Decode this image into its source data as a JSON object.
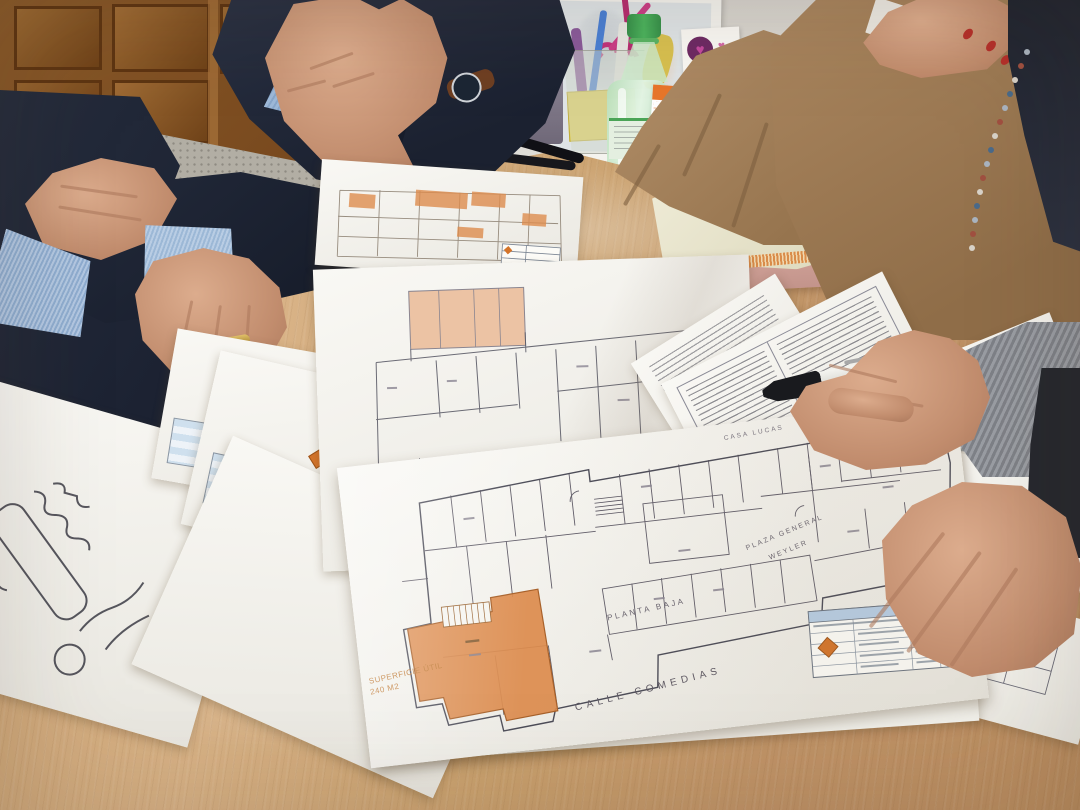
{
  "plan_labels": {
    "area_label": "SUPERFICIE ÚTIL",
    "area_value": "240 M2",
    "street_bottom": "CALLE COMEDIAS",
    "floor_label": "PLANTA BAJA",
    "plaza_line1": "PLAZA GENERAL",
    "plaza_line2": "WEYLER",
    "top_edge_label": "CASA LUCAS"
  },
  "icons": {
    "heart": "♥"
  },
  "colors": {
    "table_wood": "#c9a271",
    "plan_highlight_orange": "#dd8c4e",
    "plan_highlight_salmon": "#ecc3a4",
    "title_block_blue": "#cfe0ee",
    "diamond_logo_orange": "#d4742a",
    "bottle_cap_green": "#3f9e4e",
    "laptop_rose": "#d2a29a",
    "suit_navy": "#222938",
    "sweater_camel": "#ab8760",
    "nail_red": "#b5302a",
    "scissors_pink": "#c2347a"
  }
}
